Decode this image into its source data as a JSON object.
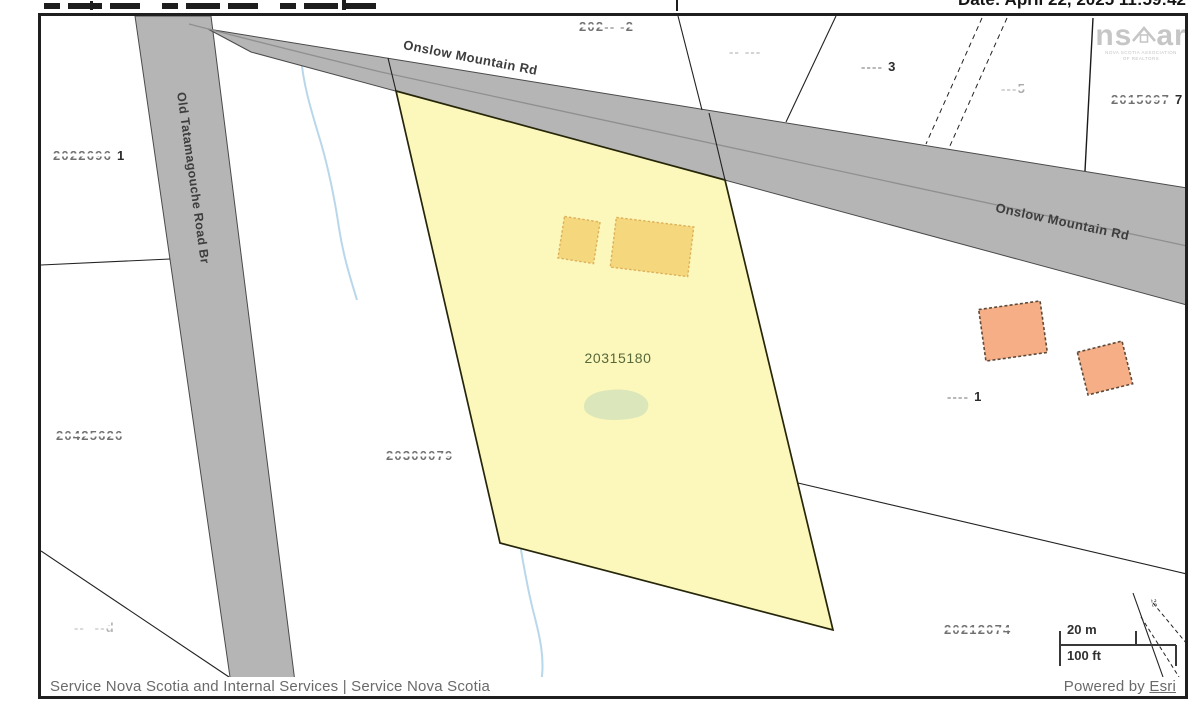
{
  "header": {
    "date_label": "Date: April 22, 2025 11:59:42"
  },
  "map": {
    "road_labels": {
      "onslow": "Onslow Mountain Rd",
      "tatamagouche": "Old Tatamagouche Road Br"
    },
    "selected_parcel": {
      "pid": "20315180"
    },
    "faint_parcels": [
      {
        "text": "2022696",
        "suffix": "1"
      },
      {
        "text": "20425626",
        "suffix": ""
      },
      {
        "text": "--  --d",
        "suffix": ""
      },
      {
        "text": "20300079",
        "suffix": ""
      },
      {
        "text": "202-- -2",
        "suffix": ""
      },
      {
        "text": "-- ---",
        "suffix": ""
      },
      {
        "text": "----",
        "suffix": "3"
      },
      {
        "text": "---5",
        "suffix": ""
      },
      {
        "text": "2015097",
        "suffix": "7"
      },
      {
        "text": "----",
        "suffix": "1"
      },
      {
        "text": "20212074",
        "suffix": ""
      },
      {
        "text": "20",
        "suffix": ""
      }
    ],
    "logo": {
      "left": "ns",
      "right": "ar",
      "caption1": "NOVA SCOTIA ASSOCIATION",
      "caption2": "OF REALTORS"
    },
    "scalebar": {
      "metric": "20 m",
      "imperial": "100 ft"
    }
  },
  "footer": {
    "attribution": "Service Nova Scotia and Internal Services | Service Nova Scotia",
    "powered_by": "Powered by ",
    "esri_link": "Esri"
  },
  "colors": {
    "selected_parcel_fill": "#fcf7ba",
    "selected_parcel_outline": "#26260a",
    "pid_text": "#57683b",
    "road_fill": "#b5b5b5",
    "building_yellow": "#f5d87e",
    "building_orange": "#f5ae85",
    "vegetation_patch": "#dbe7ba",
    "stream_blue": "#b9d7ea"
  }
}
